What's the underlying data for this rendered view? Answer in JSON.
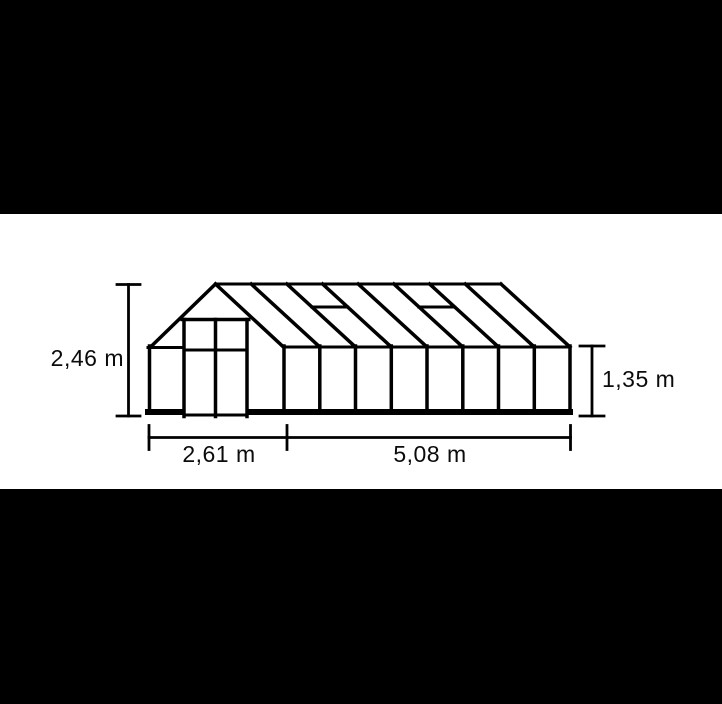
{
  "page": {
    "background_color": "#ffffff",
    "letterbox_color": "#000000"
  },
  "diagram": {
    "line_color": "#000000",
    "text_color": "#0b0b0b",
    "labels": {
      "total_height": "2,46 m",
      "eave_height": "1,35 m",
      "width": "2,61 m",
      "length": "5,08 m"
    },
    "structure": {
      "side_wall_panels": 8,
      "roof_panels": 8,
      "roof_vents": 2,
      "front_door_leaves": 2
    }
  }
}
